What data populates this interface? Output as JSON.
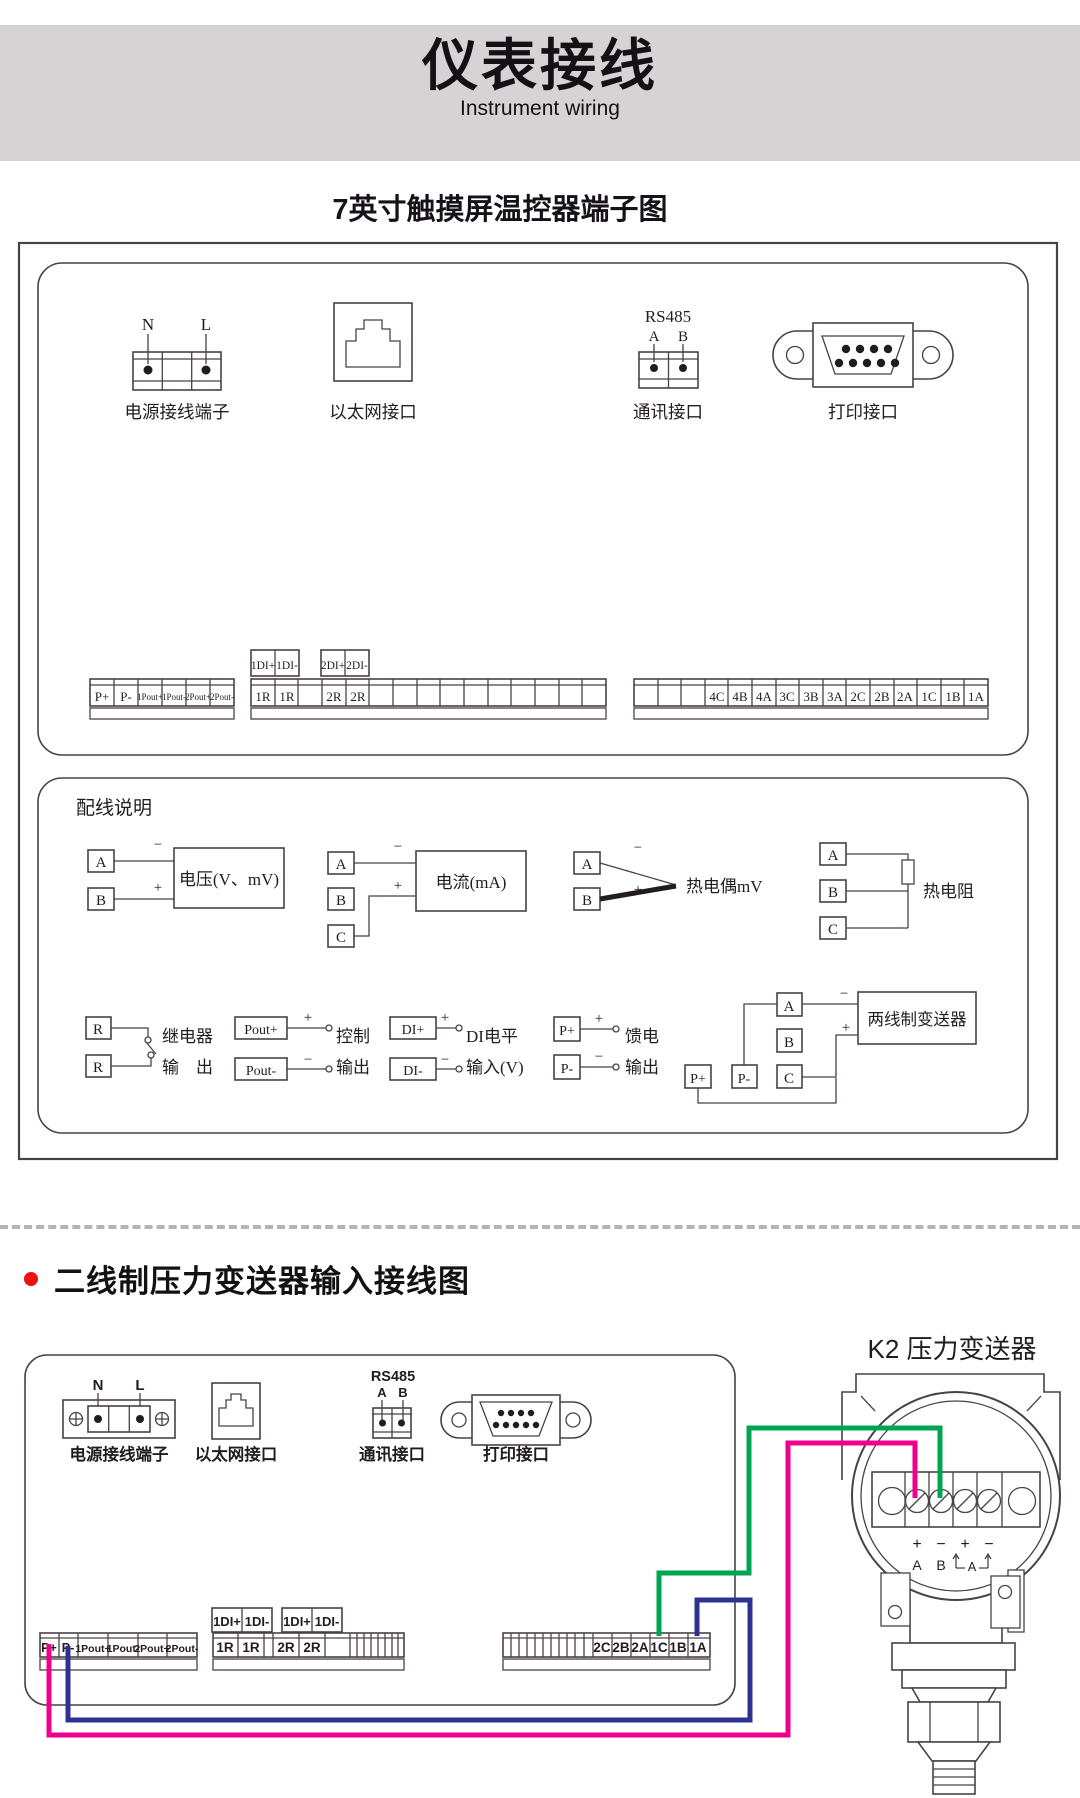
{
  "header": {
    "title": "仪表接线",
    "subtitle": "Instrument wiring"
  },
  "colors": {
    "header_band": "#d5d3d4",
    "bullet_red": "#ed1111",
    "line": "#4a4144",
    "separator": "#b4b4b4"
  },
  "section1": {
    "title": "7英寸触摸屏温控器端子图",
    "power": {
      "pin_n": "N",
      "pin_l": "L",
      "label": "电源接线端子"
    },
    "ethernet": {
      "label": "以太网接口"
    },
    "rs485": {
      "name": "RS485",
      "pin_a": "A",
      "pin_b": "B",
      "label": "通讯接口"
    },
    "printer": {
      "label": "打印接口"
    },
    "left_strip": [
      "P+",
      "P-",
      "1Pout+",
      "1Pout-",
      "2Pout+",
      "2Pout-"
    ],
    "di_pair_1": [
      "1DI+",
      "1DI-"
    ],
    "di_pair_2": [
      "2DI+",
      "2DI-"
    ],
    "mid_strip": [
      "1R",
      "1R",
      "2R",
      "2R"
    ],
    "right_strip": [
      "4C",
      "4B",
      "4A",
      "3C",
      "3B",
      "3A",
      "2C",
      "2B",
      "2A",
      "1C",
      "1B",
      "1A"
    ],
    "wiring": {
      "title": "配线说明",
      "voltage": {
        "t1": "A",
        "t2": "B",
        "minus": "−",
        "plus": "+",
        "label": "电压(V、mV)"
      },
      "current": {
        "t1": "A",
        "t2": "B",
        "t3": "C",
        "minus": "−",
        "plus": "+",
        "label": "电流(mA)"
      },
      "thermocouple": {
        "t1": "A",
        "t2": "B",
        "minus": "−",
        "plus": "+",
        "label": "热电偶mV"
      },
      "rtd": {
        "t1": "A",
        "t2": "B",
        "t3": "C",
        "label": "热电阻"
      },
      "relay": {
        "t1": "R",
        "t2": "R",
        "label_line1": "继电器",
        "label_line2": "输　出"
      },
      "control": {
        "t1": "Pout+",
        "t2": "Pout-",
        "plus": "+",
        "minus": "−",
        "label_line1": "控制",
        "label_line2": "输出"
      },
      "di": {
        "t1": "DI+",
        "t2": "DI-",
        "plus": "+",
        "minus": "−",
        "label_line1": "DI电平",
        "label_line2": "输入(V)"
      },
      "feed": {
        "t1": "P+",
        "t2": "P-",
        "plus": "+",
        "minus": "−",
        "label_line1": "馈电",
        "label_line2": "输出"
      },
      "two_wire": {
        "t1": "A",
        "t2": "B",
        "t3": "C",
        "t4": "P+",
        "t5": "P-",
        "minus": "−",
        "plus": "+",
        "label": "两线制变送器"
      }
    }
  },
  "section2": {
    "title": "二线制压力变送器输入接线图",
    "k2_label": "K2  压力变送器",
    "power": {
      "pin_n": "N",
      "pin_l": "L",
      "label": "电源接线端子"
    },
    "ethernet": {
      "label": "以太网接口"
    },
    "rs485": {
      "name": "RS485",
      "pin_a": "A",
      "pin_b": "B",
      "label": "通讯接口"
    },
    "printer": {
      "label": "打印接口"
    },
    "left_strip": [
      "P+",
      "P-",
      "1Pout+",
      "1Pout-",
      "2Pout+",
      "2Pout-"
    ],
    "di_pair_1": [
      "1DI+",
      "1DI-"
    ],
    "di_pair_2": [
      "1DI+",
      "1DI-"
    ],
    "mid_strip": [
      "1R",
      "1R",
      "2R",
      "2R"
    ],
    "right_strip": [
      "2C",
      "2B",
      "2A",
      "1C",
      "1B",
      "1A"
    ],
    "transmitter": {
      "plus_1": "+",
      "minus_1": "−",
      "plus_2": "+",
      "minus_2": "−",
      "pin_a": "A",
      "pin_b": "B",
      "pin_a2": "A"
    },
    "wire_colors": {
      "green": "#00a551",
      "pink": "#ec008c",
      "blue": "#2e3192"
    }
  }
}
